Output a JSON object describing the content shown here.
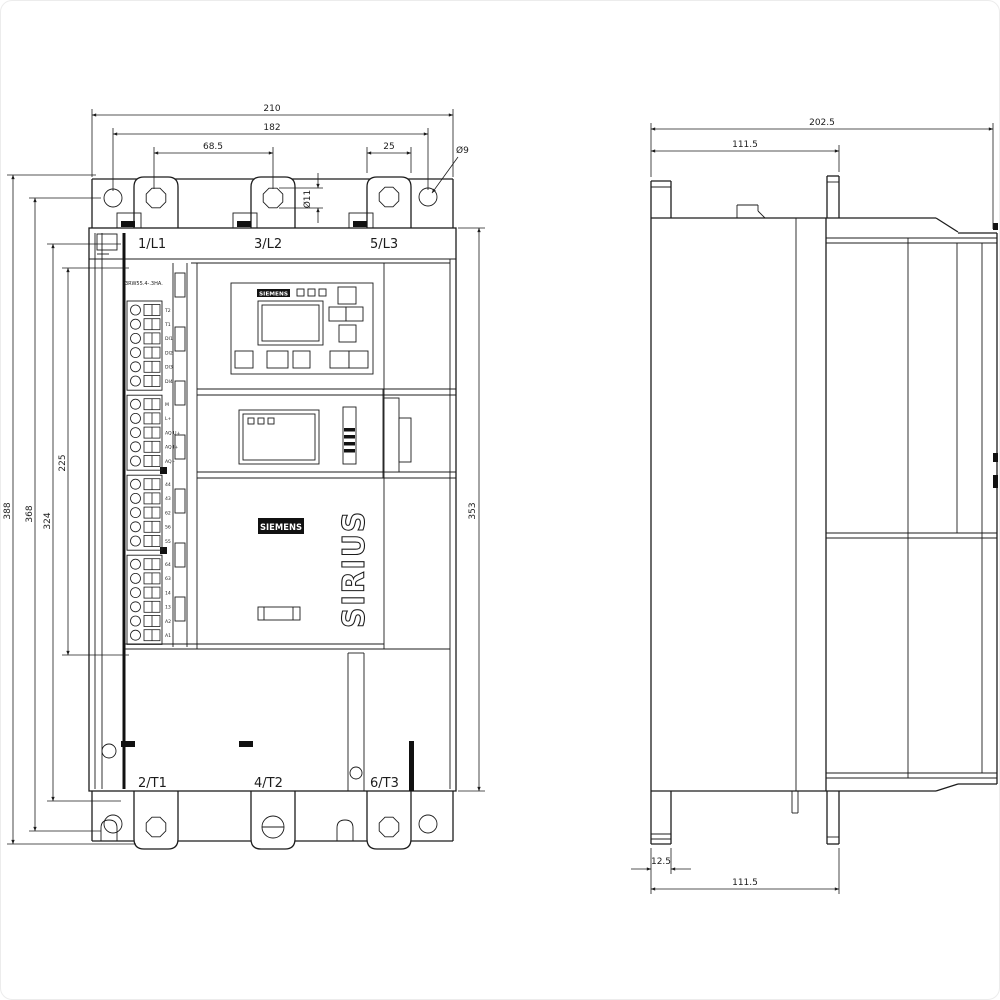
{
  "drawing": {
    "front_view": {
      "dim_width_total": "210",
      "dim_width_mounting_holes": "182",
      "dim_terminal_pitch": "68.5",
      "dim_terminal_width": "25",
      "dim_mounting_hole_dia": "Ø9",
      "dim_terminal_hole_dia": "Ø11",
      "dim_total_height": "388",
      "dim_mounting_height": "368",
      "dim_height_324": "324",
      "dim_control_module_height": "225",
      "dim_body_height": "353",
      "top_terminals": [
        "1/L1",
        "3/L2",
        "5/L3"
      ],
      "bottom_terminals": [
        "2/T1",
        "4/T2",
        "6/T3"
      ],
      "part_number": "3RW55.4-.3HA.",
      "hmi_logo": "SIEMENS",
      "brand_logo": "SIEMENS",
      "product_line": "SIRIUS",
      "terminal_groups": [
        {
          "labels": [
            "T2",
            "T1",
            "DI1",
            "DI2",
            "DI3",
            "DI4"
          ]
        },
        {
          "labels": [
            "M",
            "L+",
            "AQ U+",
            "AQ I+",
            "AQ -"
          ]
        },
        {
          "labels": [
            "44",
            "43",
            "62",
            "56",
            "55"
          ]
        },
        {
          "labels": [
            "64",
            "63",
            "14",
            "13",
            "A2",
            "A1"
          ]
        }
      ]
    },
    "side_view": {
      "dim_depth_total": "202.5",
      "dim_depth_upper": "111.5",
      "dim_base_offset": "12.5",
      "dim_depth_lower": "111.5"
    }
  }
}
